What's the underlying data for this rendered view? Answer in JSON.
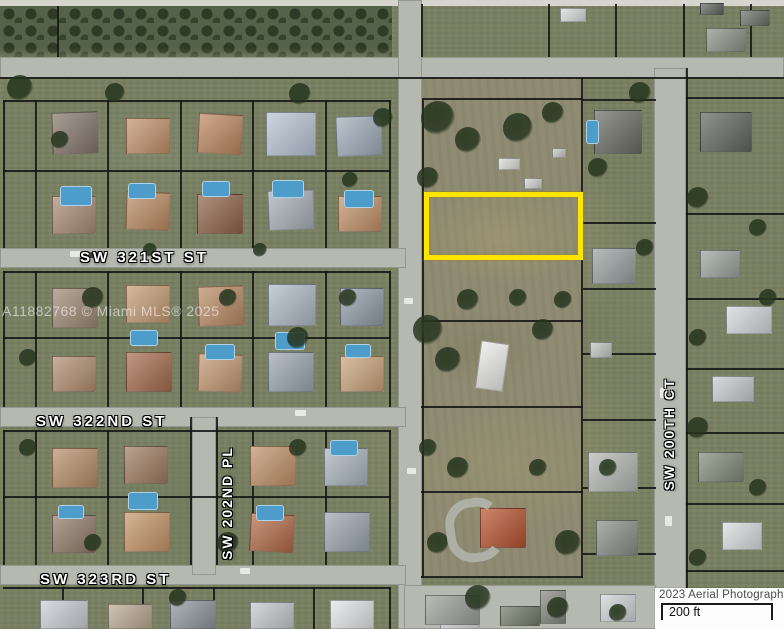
{
  "map": {
    "street_labels": [
      {
        "id": "sw-321st-st",
        "label": "SW 321ST ST",
        "orientation": "horizontal"
      },
      {
        "id": "sw-322nd-st",
        "label": "SW 322ND ST",
        "orientation": "horizontal"
      },
      {
        "id": "sw-323rd-st",
        "label": "SW 323RD ST",
        "orientation": "horizontal"
      },
      {
        "id": "sw-202nd-pl",
        "label": "SW 202ND PL",
        "orientation": "vertical"
      },
      {
        "id": "sw-200th-ct",
        "label": "SW 200TH CT",
        "orientation": "vertical"
      }
    ],
    "watermark": "A11882768 © Miami MLS® 2025",
    "colors": {
      "highlight": "#FFE400",
      "road": "#b6b9b0",
      "boundary": "#161616",
      "pool": "#4d9cc9"
    }
  },
  "footer": {
    "attribution": "2023 Aerial Photography",
    "scale_label": "200 ft"
  }
}
